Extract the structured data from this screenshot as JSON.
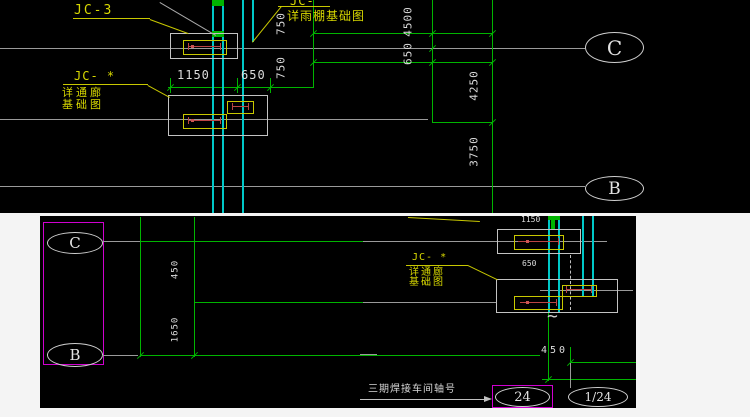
{
  "top": {
    "jc3_label": "JC-3",
    "jc_star_label": "JC- *",
    "jc_star_note_line1": "详通廊",
    "jc_star_note_line2": "基础图",
    "jc_top_label": "JC-",
    "jc_top_note": "详雨棚基础图",
    "dim_1150": "1150",
    "dim_650": "650",
    "dim_750_upper": "750",
    "dim_750_lower": "750",
    "dim_4500": "4500",
    "dim_650_right": "650",
    "dim_4250": "4250",
    "dim_3750": "3750",
    "axis_c": "C",
    "axis_b": "B"
  },
  "bottom": {
    "axis_c": "C",
    "axis_b": "B",
    "dim_450_left": "450",
    "dim_1650": "1650",
    "dim_1150": "1150",
    "dim_650": "650",
    "dim_450": "450",
    "jc_star_label": "JC- *",
    "jc_note_line1": "详通廊",
    "jc_note_line2": "基础图",
    "break_symbol": "~",
    "caption": "三期焊接车间轴号",
    "grid_24": "24",
    "grid_1_24": "1/24"
  },
  "colors": {
    "drawing_background": "#000000",
    "grid_green": "#00b400",
    "wall_cyan": "#00c8c8",
    "annotation_yellow": "#c8c800",
    "highlight_magenta": "#d000d0",
    "foundation_red": "#bb4444",
    "axis_gray": "#9a9a9a",
    "dim_text_white": "#dcdcdc"
  }
}
